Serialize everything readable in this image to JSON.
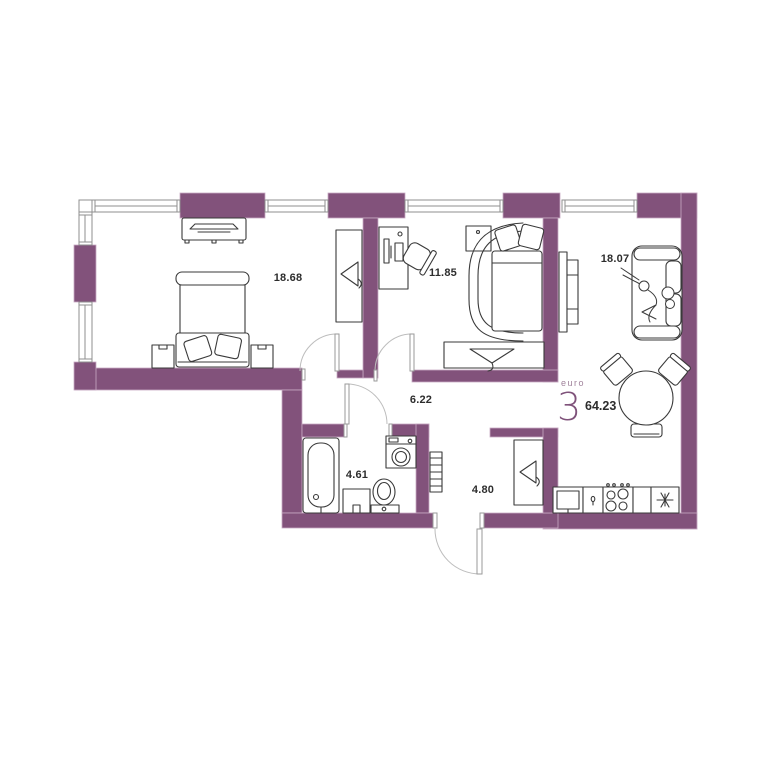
{
  "plan": {
    "type": "apartment-floor-plan",
    "badge": {
      "prefix": "euro",
      "count": "3",
      "total_area": "64.23"
    },
    "rooms": {
      "bedroom": {
        "area": "18.68"
      },
      "second_bedroom": {
        "area": "11.85"
      },
      "living_room": {
        "area": "18.07"
      },
      "hallway": {
        "area": "6.22"
      },
      "bathroom": {
        "area": "4.61"
      },
      "corridor": {
        "area": "4.80"
      }
    },
    "icons": [
      "double-bed",
      "nightstand",
      "tv-console",
      "wardrobe-hanger",
      "desk-computer",
      "office-chair",
      "single-bed",
      "tv-panel",
      "sofa",
      "person-lying",
      "dining-table",
      "chair",
      "bathtub",
      "vanity-cabinet",
      "toilet",
      "washing-machine",
      "towel-radiator",
      "kitchen-sink",
      "faucet",
      "stove-burners",
      "fridge-snowflake"
    ],
    "colors": {
      "wall": "#82527b",
      "wall_edge": "#c9abc4",
      "furniture_line": "#3a3a3a",
      "door_arc": "#bdbdbd",
      "door_jamb": "#9a9a9a",
      "window_line": "#8f8f8f",
      "label": "#2d2d2d",
      "accent": "#7f527a",
      "accent_soft": "#a1839c",
      "background": "#ffffff"
    }
  }
}
